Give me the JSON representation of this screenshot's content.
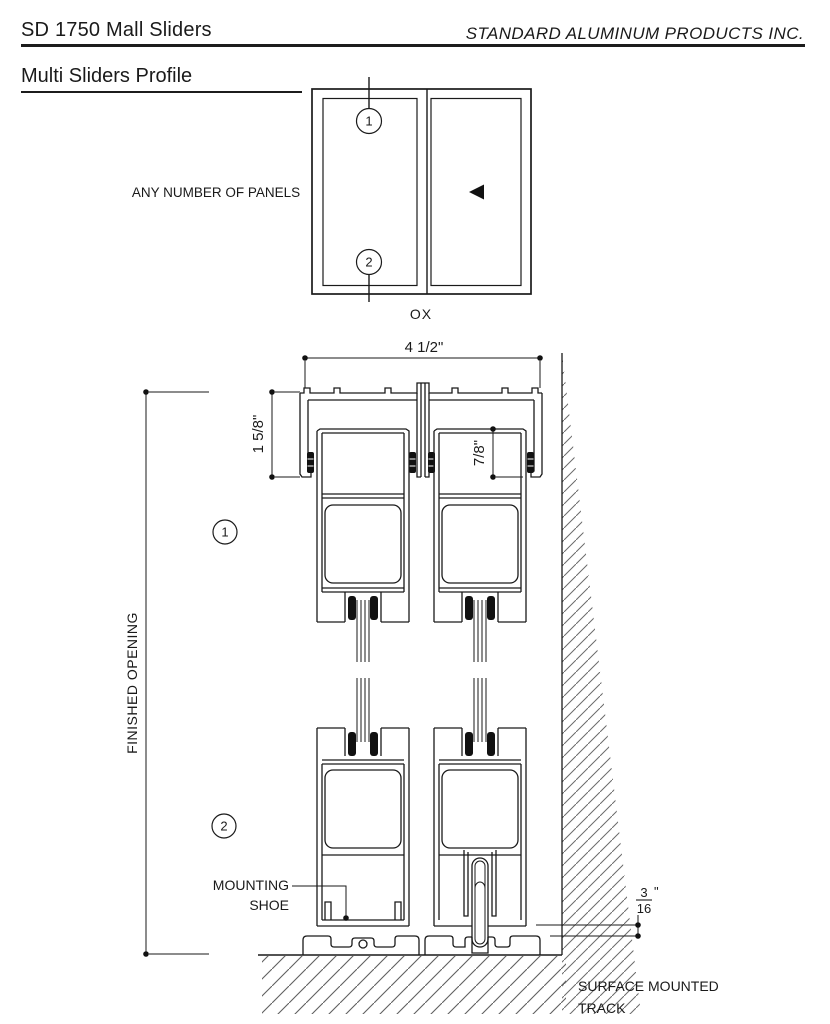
{
  "header": {
    "product_code": "SD 1750 Mall Sliders",
    "company": "STANDARD ALUMINUM PRODUCTS INC.",
    "subtitle": "Multi Sliders Profile"
  },
  "plan_view": {
    "panels_label": "ANY NUMBER OF PANELS",
    "config_label": "OX",
    "callout_1": "1",
    "callout_2": "2"
  },
  "section_view": {
    "dim_overall_width": "4 1/2\"",
    "dim_head_height": "1 5/8\"",
    "dim_panel_pocket": "7/8\"",
    "dim_clearance_numerator": "3",
    "dim_clearance_denominator": "16",
    "dim_clearance_unit": "\"",
    "finished_opening_label": "FINISHED OPENING",
    "mounting_shoe_line1": "MOUNTING",
    "mounting_shoe_line2": "SHOE",
    "track_label_line1": "SURFACE MOUNTED",
    "track_label_line2": "TRACK",
    "callout_1": "1",
    "callout_2": "2"
  },
  "colors": {
    "line": "#1a1a1a",
    "hatch": "#6b6b6b",
    "background": "#ffffff"
  }
}
